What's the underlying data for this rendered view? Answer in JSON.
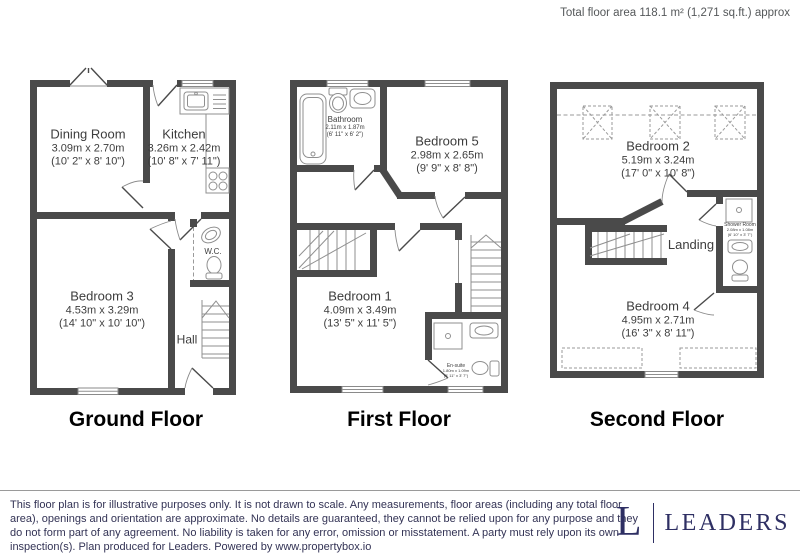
{
  "header": {
    "total_area": "Total floor area 118.1 m² (1,271 sq.ft.) approx"
  },
  "ground": {
    "title": "Ground Floor",
    "dining": {
      "name": "Dining Room",
      "metric": "3.09m x 2.70m",
      "imperial": "(10' 2\" x 8' 10\")"
    },
    "kitchen": {
      "name": "Kitchen",
      "metric": "3.26m x 2.42m",
      "imperial": "(10' 8\" x 7' 11\")"
    },
    "bedroom3": {
      "name": "Bedroom 3",
      "metric": "4.53m x 3.29m",
      "imperial": "(14' 10\" x 10' 10\")"
    },
    "wc": {
      "name": "W.C."
    },
    "hall": {
      "name": "Hall"
    }
  },
  "first": {
    "title": "First Floor",
    "bathroom": {
      "name": "Bathroom",
      "metric": "2.11m x 1.87m",
      "imperial": "(6' 11\" x 6' 2\")"
    },
    "bedroom5": {
      "name": "Bedroom 5",
      "metric": "2.98m x 2.65m",
      "imperial": "(9' 9\" x 8' 8\")"
    },
    "bedroom1": {
      "name": "Bedroom 1",
      "metric": "4.09m x 3.49m",
      "imperial": "(13' 5\" x 11' 5\")"
    },
    "ensuite": {
      "name": "En-suite",
      "metric": "1.80m x 1.09m",
      "imperial": "(5' 11\" x 3' 7\")"
    }
  },
  "second": {
    "title": "Second Floor",
    "bedroom2": {
      "name": "Bedroom 2",
      "metric": "5.19m x 3.24m",
      "imperial": "(17' 0\" x 10' 8\")"
    },
    "landing": {
      "name": "Landing"
    },
    "shower": {
      "name": "Shower Room",
      "metric": "2.08m x 1.08m",
      "imperial": "(6' 10\" x 3' 7\")"
    },
    "bedroom4": {
      "name": "Bedroom 4",
      "metric": "4.95m x 2.71m",
      "imperial": "(16' 3\" x 8' 11\")"
    }
  },
  "footer": {
    "disclaimer": "This floor plan is for illustrative purposes only. It is not drawn to scale. Any measurements, floor areas (including any total floor area), openings and orientation are approximate. No details are guaranteed, they cannot be relied upon for any purpose and they do not form part of any agreement. No liability is taken for any error, omission or misstatement. A party must rely upon its own inspection(s). Plan produced for Leaders. Powered by www.propertybox.io",
    "brand_letter": "L",
    "brand_name": "LEADERS"
  },
  "colors": {
    "wall": "#4a4a4a",
    "label_text": "#3d3d3d",
    "footer_text": "#333355",
    "brand": "#2e2f63"
  }
}
